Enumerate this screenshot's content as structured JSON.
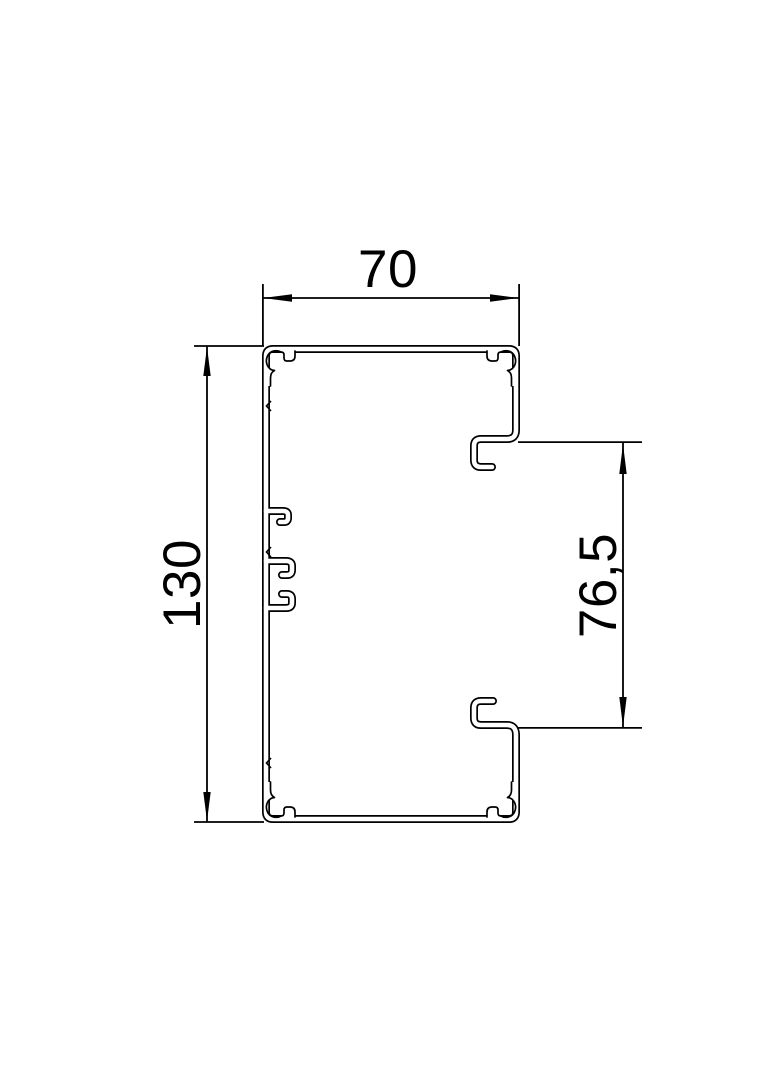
{
  "drawing": {
    "type": "technical-cross-section",
    "subject": "cable trunking profile with cover opening",
    "background_color": "#ffffff",
    "line_color": "#000000"
  },
  "dimensions": {
    "width": {
      "label": "70",
      "orientation": "horizontal",
      "position": "top"
    },
    "height": {
      "label": "130",
      "orientation": "vertical",
      "position": "left"
    },
    "cover_opening": {
      "label": "76,5",
      "orientation": "vertical",
      "position": "right"
    }
  }
}
